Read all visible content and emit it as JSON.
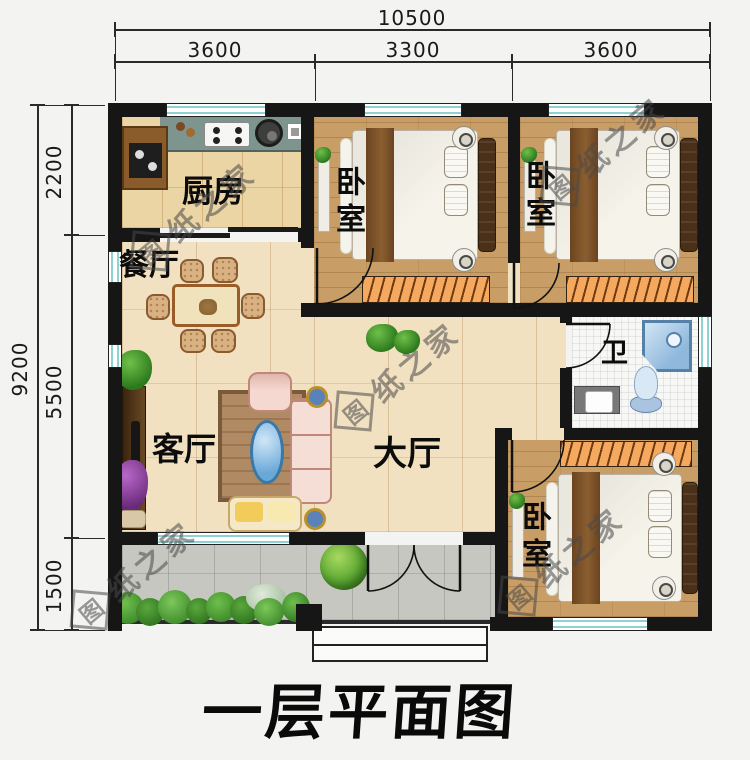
{
  "title": "一层平面图",
  "watermark": {
    "logo": "图",
    "text": "纸之家"
  },
  "dims": {
    "top_total": "10500",
    "top_segments": [
      "3600",
      "3300",
      "3600"
    ],
    "left_total": "9200",
    "left_segments": [
      "2200",
      "5500",
      "1500"
    ]
  },
  "rooms": {
    "kitchen": "厨房",
    "dining": "餐厅",
    "living": "客厅",
    "hall": "大厅",
    "bedroom": "卧室",
    "bath": "卫"
  },
  "colors": {
    "wall": "#161616",
    "wood_floor": "#c89e66",
    "hall_floor": "#f2e1c0",
    "kitchen_floor": "#ecd5a4",
    "porch_floor": "#c7c7c1",
    "window_stripe": "#8fd2d2",
    "wardrobe": "#f5a95f",
    "counter": "#7e948f",
    "sofa_pink": "#f5ded6",
    "fixture_blue": "#a9c8e4",
    "tree_green": "#5aa832",
    "watermark_gray": "#484848",
    "title_color": "#0a0a0a"
  }
}
